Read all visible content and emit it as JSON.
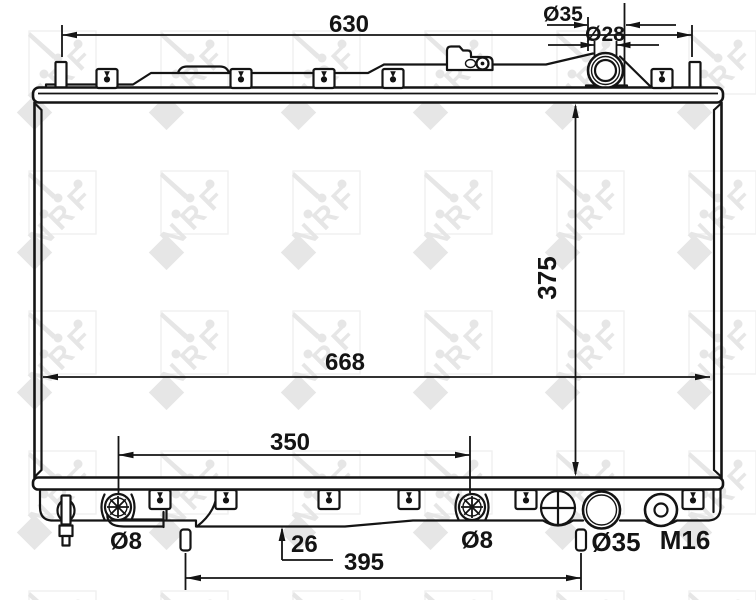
{
  "meta": {
    "title": "Radiator dimensional technical drawing",
    "watermark": "NRF"
  },
  "colors": {
    "line": "#141414",
    "background": "#ffffff",
    "watermark_glyph": "#e6e6e6",
    "watermark_box": "#efefef"
  },
  "labels": {
    "dim_top_width": "630",
    "dim_neck_outer": "Ø35",
    "dim_neck_inner": "Ø28",
    "dim_core_height": "375",
    "dim_overall_width": "668",
    "dim_fitting_span": "350",
    "dim_left_fitting": "Ø8",
    "dim_pin_protrusion": "26",
    "dim_pin_span": "395",
    "dim_right_fitting": "Ø8",
    "dim_outlet": "Ø35",
    "dim_drain_thread": "M16"
  }
}
